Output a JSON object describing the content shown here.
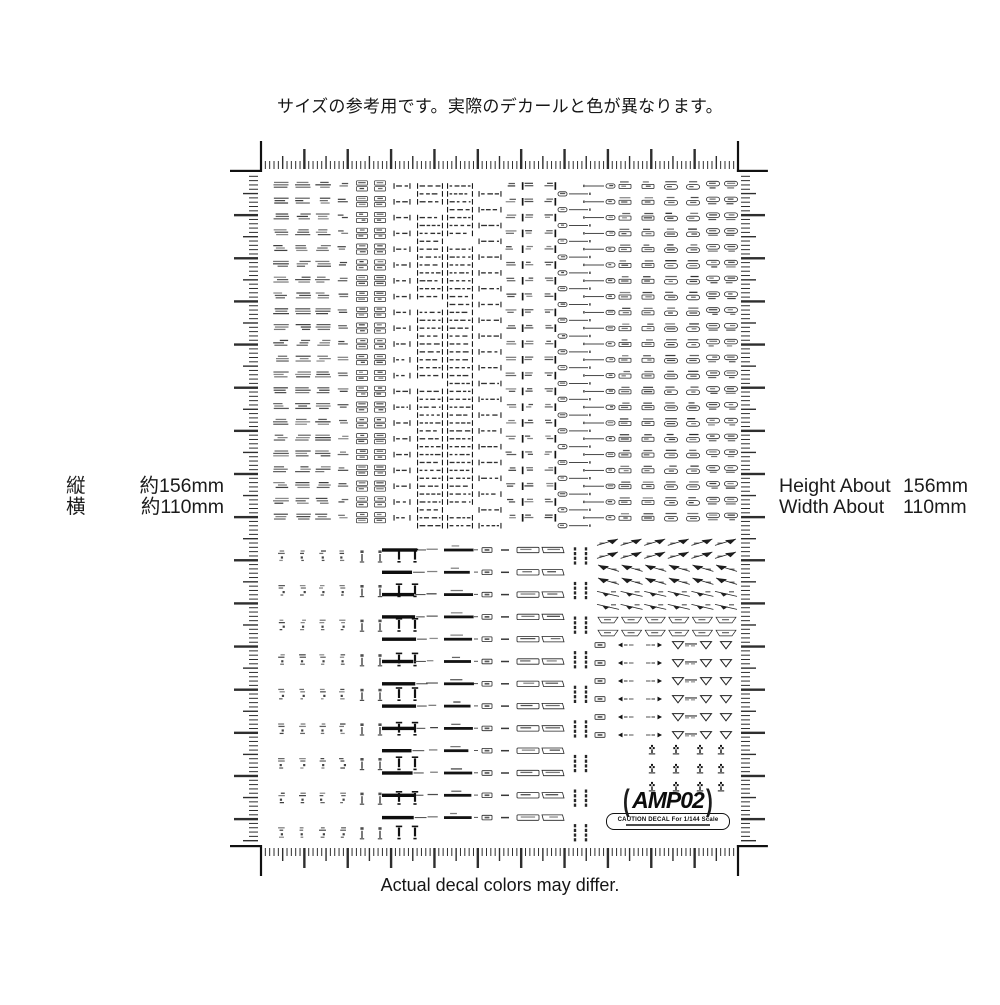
{
  "captions": {
    "top": "サイズの参考用です。実際のデカールと色が異なります。",
    "bottom": "Actual decal colors may differ."
  },
  "measurements": {
    "left": {
      "rows": [
        {
          "label": "縦",
          "value": "約156mm"
        },
        {
          "label": "横",
          "value": "約110mm"
        }
      ]
    },
    "right": {
      "rows": [
        {
          "label": "Height About",
          "value": "156mm"
        },
        {
          "label": "Width About",
          "value": "110mm"
        }
      ]
    }
  },
  "logo": {
    "bracket_left": "(",
    "text": "AMP02",
    "bracket_right": ")",
    "caption": "CAUTION DECAL For 1/144 Scale"
  },
  "sheet": {
    "ink": "#1a1a1a",
    "tick_color": "#2e2e2e",
    "frame": {
      "x0": 261,
      "x1": 738,
      "y0": 172,
      "y1": 845,
      "mmW": 110,
      "mmH": 156,
      "cornerArm": 31,
      "cornerStroke": 2.2
    },
    "ticks": {
      "minor": [
        8,
        1
      ],
      "mid": [
        13,
        1.4
      ],
      "major": [
        20,
        2.4
      ],
      "minorW": [
        9,
        1
      ],
      "midW": [
        15,
        1.4
      ],
      "majorW": [
        24,
        2.4
      ]
    },
    "topGrid": {
      "y0": 186,
      "rows": 22,
      "rowStep": 15.8,
      "cols": [
        {
          "x": 281,
          "kind": "t2"
        },
        {
          "x": 303,
          "kind": "t2"
        },
        {
          "x": 323,
          "kind": "t2"
        },
        {
          "x": 343,
          "kind": "t2s"
        },
        {
          "x": 362,
          "kind": "box2"
        },
        {
          "x": 380,
          "kind": "box2"
        },
        {
          "x": 402,
          "kind": "brk",
          "w": 17
        },
        {
          "x": 430,
          "kind": "brk",
          "w": 26,
          "dense": true
        },
        {
          "x": 460,
          "kind": "brk",
          "w": 26,
          "dense": true
        },
        {
          "x": 490,
          "kind": "brk",
          "w": 23,
          "off": true
        },
        {
          "x": 511,
          "kind": "t2s"
        },
        {
          "x": 529,
          "kind": "tagB"
        },
        {
          "x": 549,
          "kind": "tagB",
          "mir": true
        },
        {
          "x": 574,
          "kind": "dashP",
          "off": true
        },
        {
          "x": 601,
          "kind": "dashP",
          "mir": true
        },
        {
          "x": 625,
          "kind": "tag2"
        },
        {
          "x": 648,
          "kind": "tag2"
        },
        {
          "x": 671,
          "kind": "pillT"
        },
        {
          "x": 693,
          "kind": "pillT"
        },
        {
          "x": 713,
          "kind": "pill2"
        },
        {
          "x": 731,
          "kind": "pill2"
        }
      ]
    },
    "bottomMarks": {
      "y0": 556,
      "rows": 9,
      "rowStep": 34.6,
      "cols": [
        {
          "x": 282,
          "kind": "vmark"
        },
        {
          "x": 303,
          "kind": "vmark"
        },
        {
          "x": 323,
          "kind": "vmark"
        },
        {
          "x": 343,
          "kind": "vmark"
        },
        {
          "x": 362,
          "kind": "vmark2"
        },
        {
          "x": 380,
          "kind": "vmark2"
        },
        {
          "x": 399,
          "kind": "excl"
        },
        {
          "x": 415,
          "kind": "excl"
        }
      ]
    },
    "barRows": {
      "y0": 550,
      "rows": 13,
      "rowStep": 22.3,
      "cols": [
        {
          "x": 420,
          "kind": "barA"
        },
        {
          "x": 458,
          "kind": "barB"
        },
        {
          "x": 487,
          "kind": "tagC"
        },
        {
          "x": 505,
          "kind": "dashD"
        },
        {
          "x": 528,
          "kind": "boxE"
        },
        {
          "x": 553,
          "kind": "boxF"
        }
      ]
    },
    "vbars": {
      "y0": 556,
      "rows": 9,
      "rowStep": 34.6,
      "cols": [
        {
          "x": 575,
          "kind": "vbar"
        },
        {
          "x": 586,
          "kind": "vbar"
        }
      ]
    },
    "wings": {
      "y0": 542,
      "rows": 8,
      "rowStep": 13,
      "x0": 608,
      "colStep": 23.6,
      "colsN": 6,
      "rowKinds": [
        "wr",
        "wr",
        "wl",
        "wl",
        "sr",
        "sr",
        "tz",
        "tz"
      ]
    },
    "arrowRows": {
      "y0": 645,
      "rows": 6,
      "rowStep": 18,
      "cols": [
        {
          "x": 600,
          "kind": "tagC"
        },
        {
          "x": 626,
          "kind": "arrowL"
        },
        {
          "x": 654,
          "kind": "arrowR"
        },
        {
          "x": 678,
          "kind": "triL"
        },
        {
          "x": 704,
          "kind": "triR"
        },
        {
          "x": 726,
          "kind": "tri"
        }
      ]
    },
    "trefoils": {
      "rows": [
        750,
        769,
        787
      ],
      "cols": [
        652,
        676,
        700,
        721
      ]
    }
  }
}
